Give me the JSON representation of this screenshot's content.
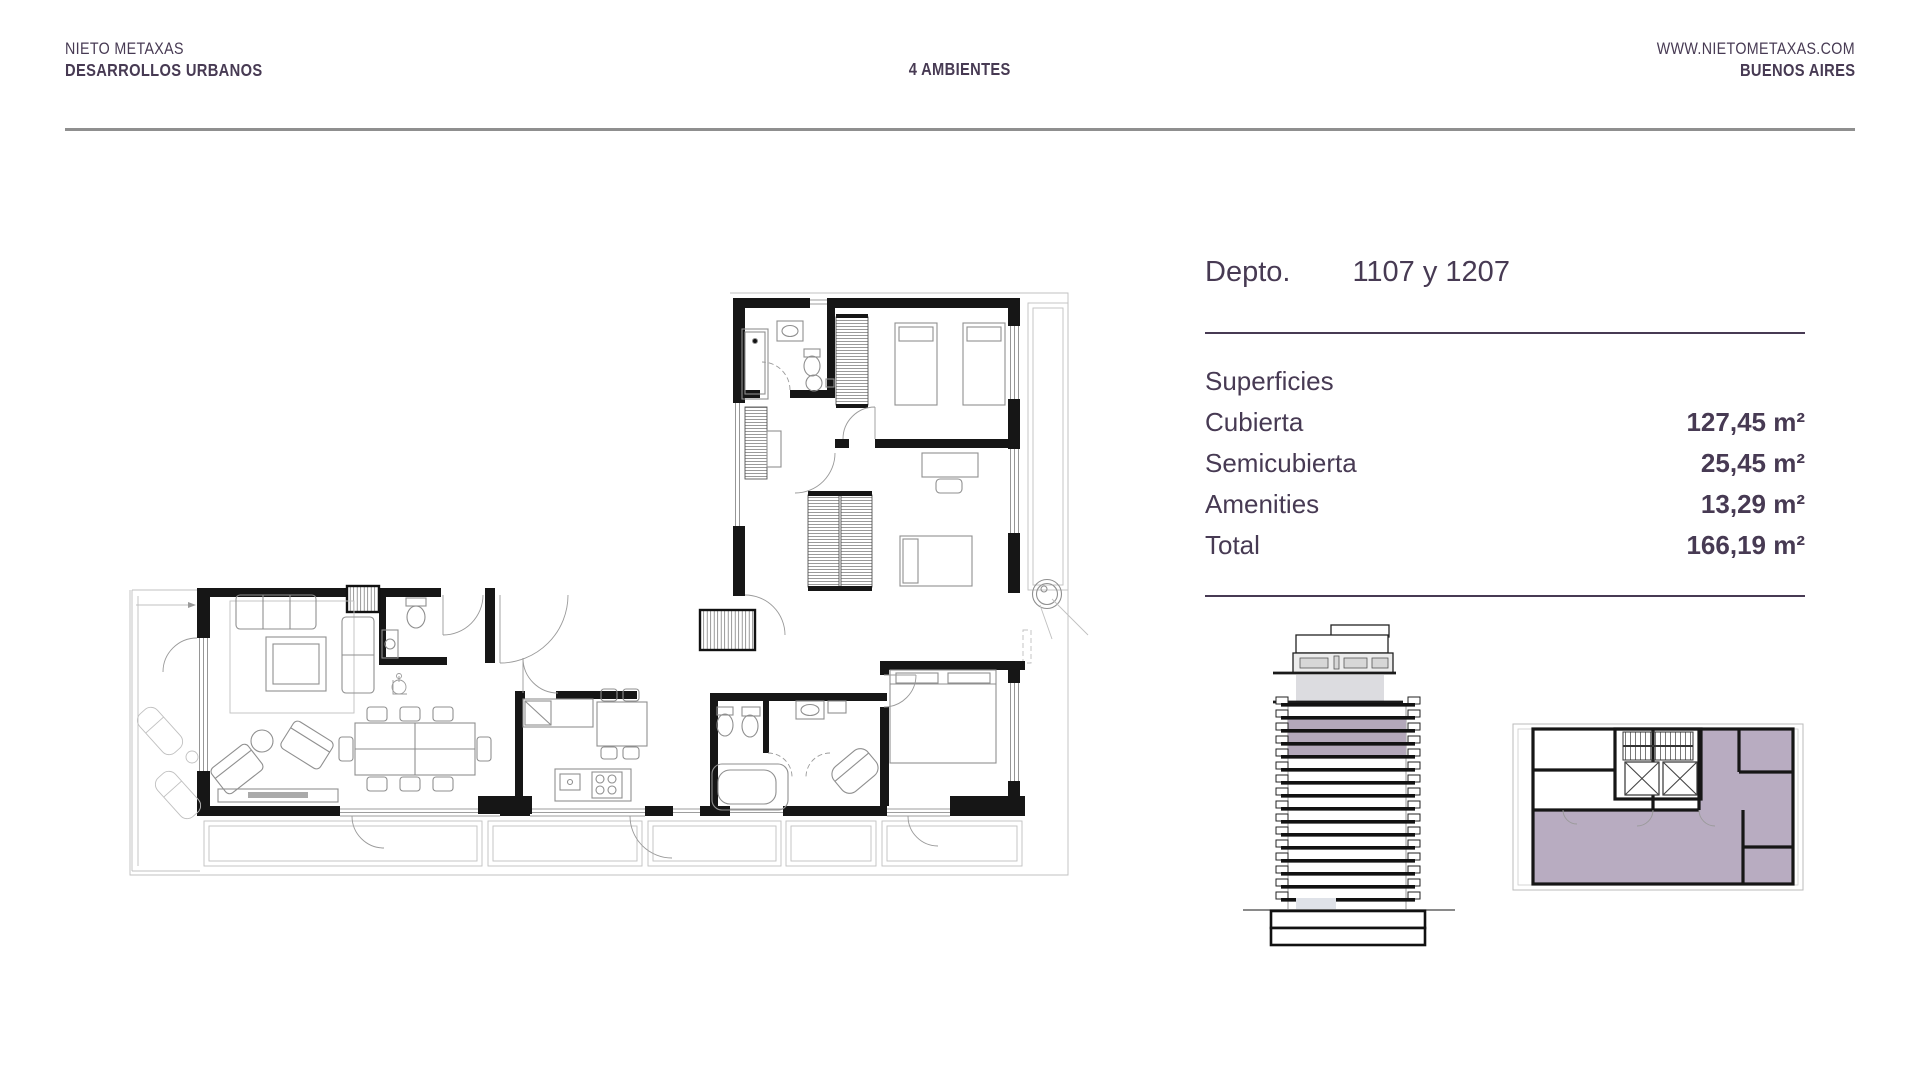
{
  "header": {
    "brand_line1": "NIETO METAXAS",
    "brand_line2": "DESARROLLOS URBANOS",
    "center_title": "4 AMBIENTES",
    "website": "WWW.NIETOMETAXAS.COM",
    "city": "BUENOS AIRES"
  },
  "unit_info": {
    "label": "Depto.",
    "number": "1107 y 1207",
    "surfaces_title": "Superficies",
    "rows": [
      {
        "label": "Cubierta",
        "value": "127,45 m²"
      },
      {
        "label": "Semicubierta",
        "value": "25,45 m²"
      },
      {
        "label": "Amenities",
        "value": "13,29 m²"
      },
      {
        "label": "Total",
        "value": "166,19 m²"
      }
    ]
  },
  "colors": {
    "text_purple": "#473a53",
    "tower_highlight": "#b3a8ba",
    "keyplan_highlight": "#b8acc1",
    "header_divider": "#8f8f8f"
  }
}
